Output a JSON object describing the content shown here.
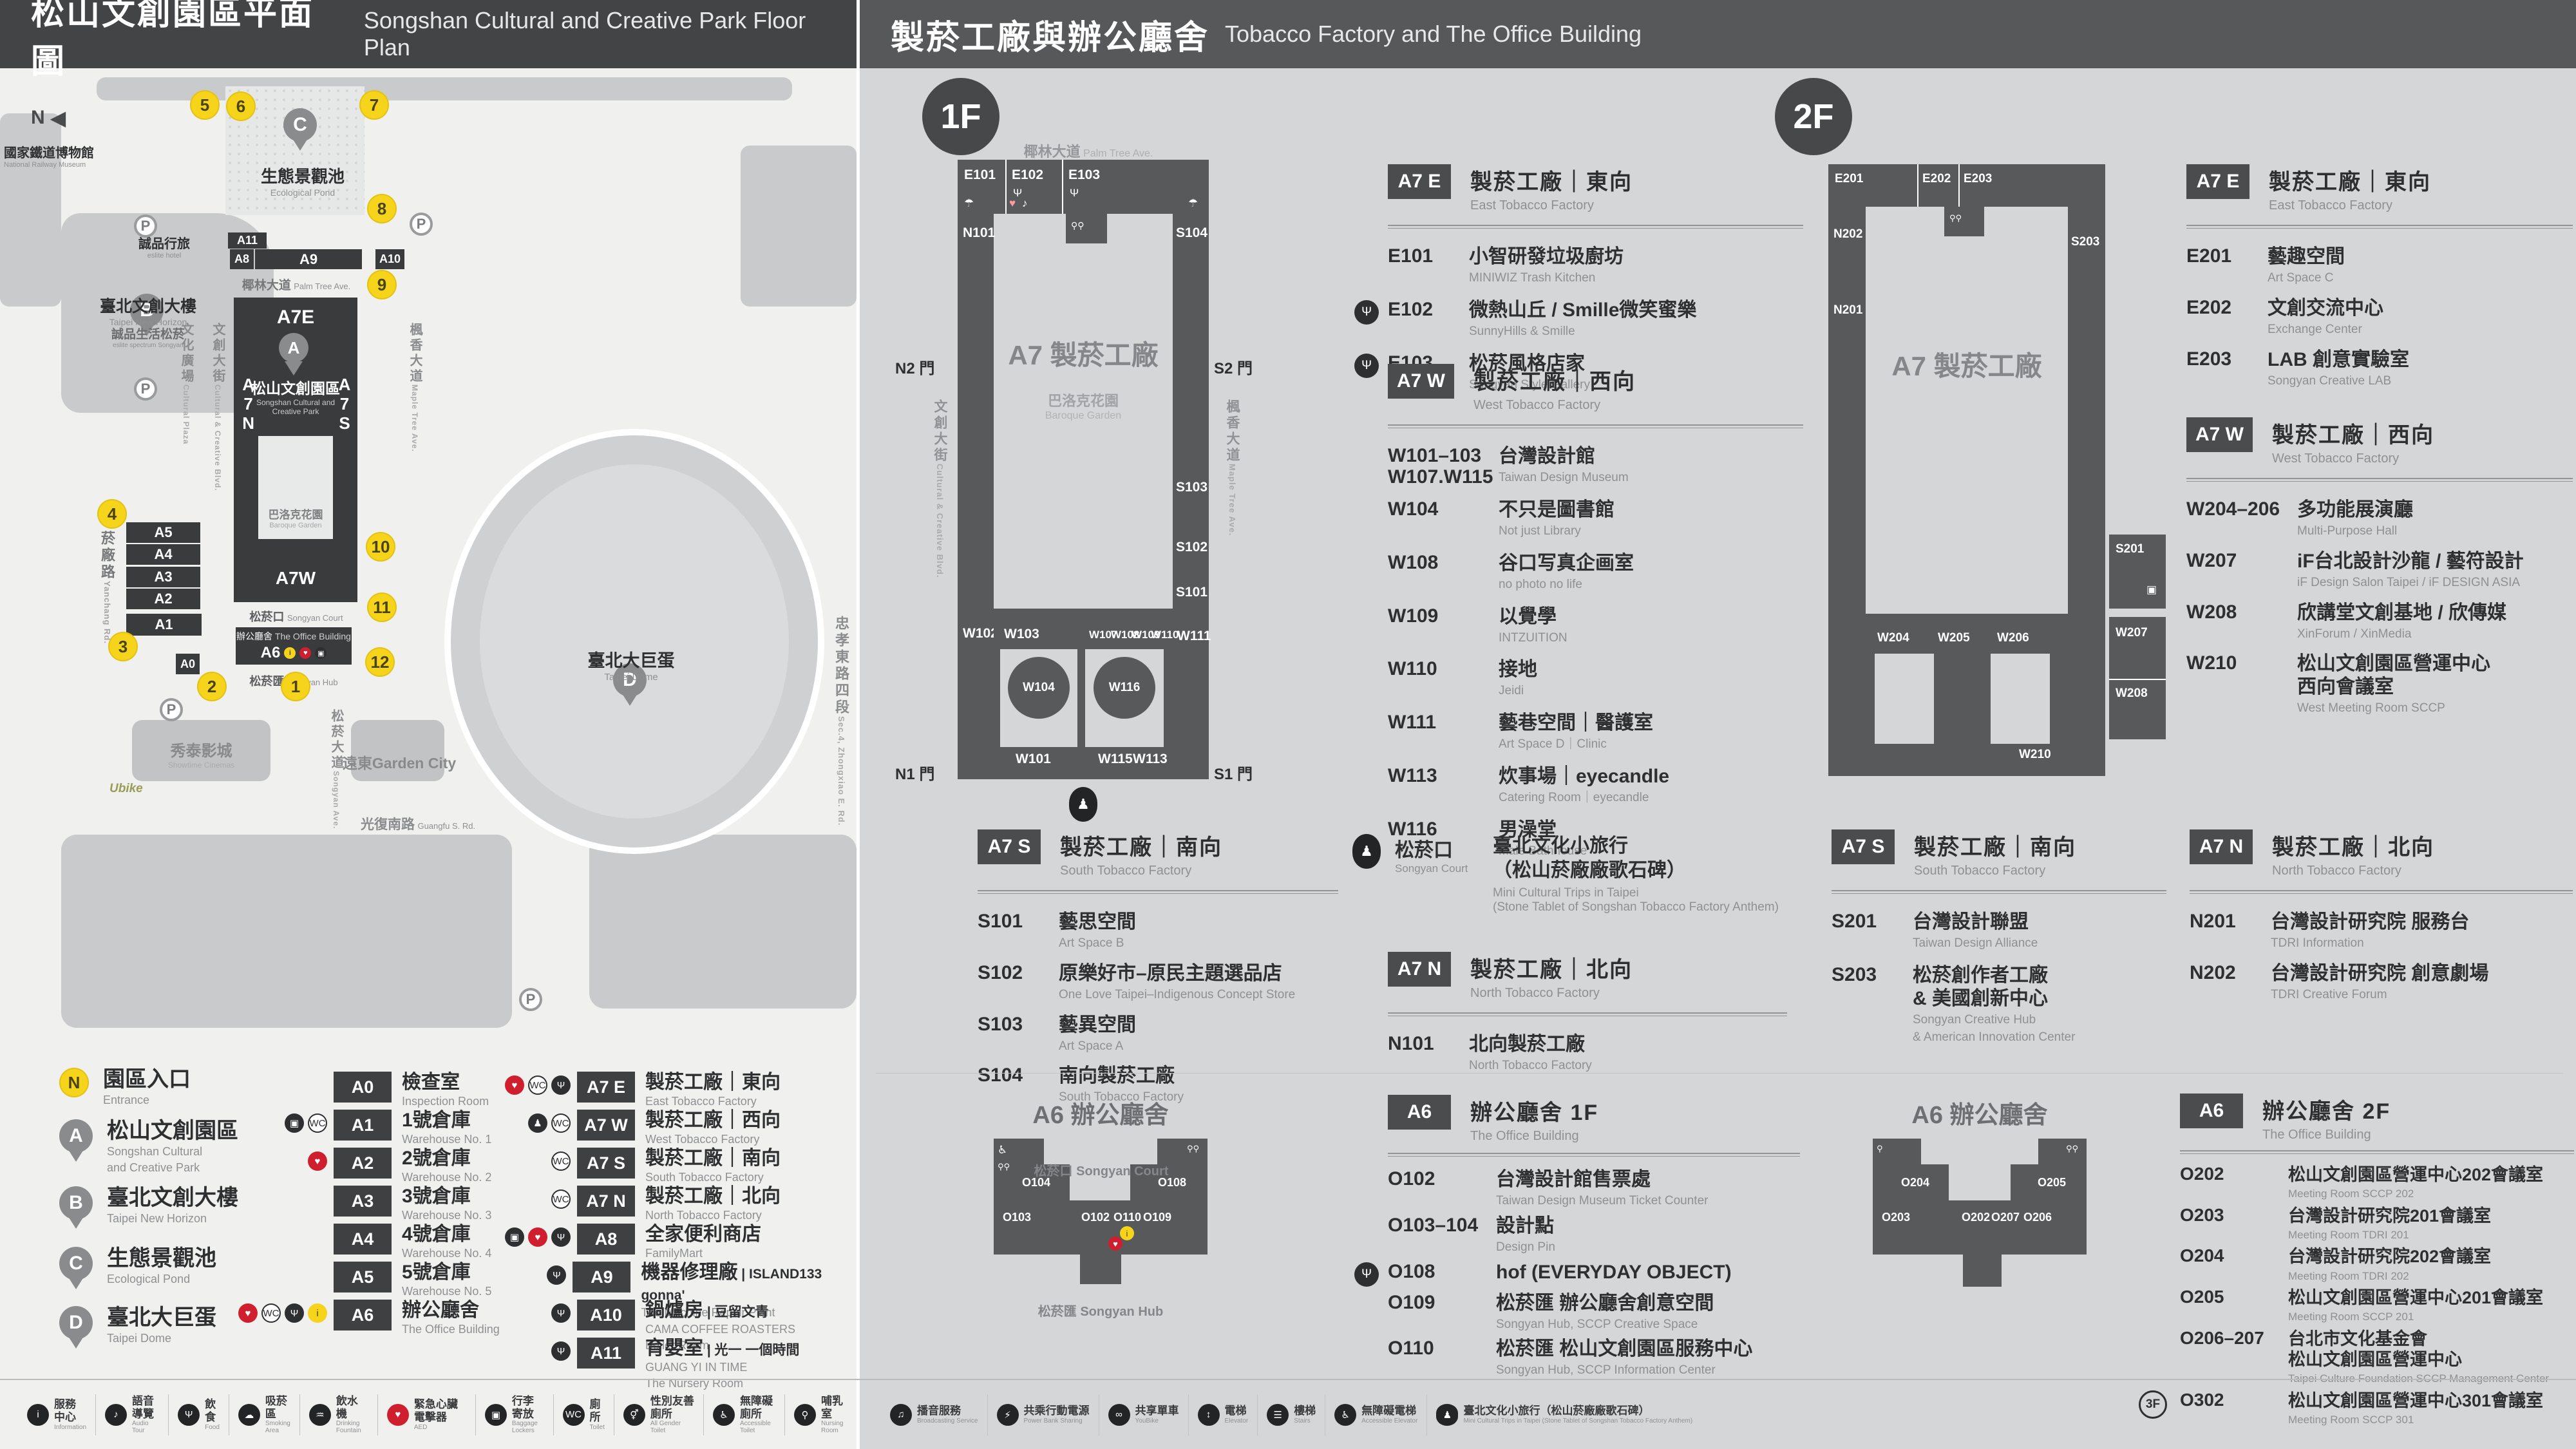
{
  "header": {
    "left": {
      "zh": "松山文創園區平面圖",
      "en": "Songshan Cultural and Creative Park Floor Plan"
    },
    "right": {
      "zh": "製菸工廠與辦公廳舍",
      "en": "Tobacco Factory and The Office Building"
    }
  },
  "park": {
    "compass": "N",
    "parking": "P",
    "ubike": "Ubike",
    "museum": {
      "zh": "國家鐵道博物館",
      "en": "National Railway Museum"
    },
    "pond": {
      "letter": "C",
      "zh": "生態景觀池",
      "en": "Ecological Pond"
    },
    "eslite_hotel": {
      "zh": "誠品行旅",
      "en": "eslite hotel"
    },
    "new_horizon": {
      "letter": "B",
      "zh": "臺北文創大樓",
      "en": "Taipei New Horizon"
    },
    "eslite_spectrum": {
      "zh": "誠品生活松菸",
      "en": "eslite spectrum Songyan"
    },
    "sccp": {
      "letter": "A",
      "zh": "松山文創園區",
      "en1": "Songshan Cultural and",
      "en2": "Creative Park"
    },
    "baroque": {
      "zh": "巴洛克花園",
      "en": "Baroque Garden"
    },
    "court": {
      "zh": "松菸口",
      "en": "Songyan Court"
    },
    "office": {
      "zh": "辦公廳舍",
      "en": "The Office Building"
    },
    "hub": {
      "zh": "松菸匯",
      "en": "Songyan Hub"
    },
    "dome": {
      "letter": "D",
      "zh": "臺北大巨蛋",
      "en": "Taipei Dome"
    },
    "cinema": {
      "zh": "秀泰影城",
      "en": "Showtime Cinemas"
    },
    "garden_city": {
      "zh": "遠東Garden City"
    },
    "roads": {
      "yanchang": {
        "zh": "菸廠路",
        "en": "Yanchang Rd."
      },
      "zhongxiao": {
        "zh": "忠孝東路四段",
        "en": "Sec.4, Zhongxiao E. Rd."
      },
      "guangfu": {
        "zh": "光復南路",
        "en": "Guangfu S. Rd."
      },
      "palm": {
        "zh": "椰林大道",
        "en": "Palm Tree Ave."
      },
      "ccblvd": {
        "zh": "文創大街",
        "en": "Cultural & Creative Blvd."
      },
      "maple": {
        "zh": "楓香大道",
        "en": "Maple Tree Ave."
      },
      "plaza": {
        "zh": "文化廣場",
        "en": "Cultural Plaza"
      },
      "songyan": {
        "zh": "松菸大道",
        "en": "Songyan Ave."
      }
    },
    "blocks": {
      "a11": "A11",
      "a8": "A8",
      "a9": "A9",
      "a10": "A10",
      "a7e": "A7E",
      "a7w": "A7W",
      "a7n": "A7N",
      "a7s": "A7S",
      "a5": "A5",
      "a4": "A4",
      "a3": "A3",
      "a2": "A2",
      "a1": "A1",
      "a0": "A0",
      "a6": "A6"
    },
    "markers": [
      "1",
      "2",
      "3",
      "4",
      "5",
      "6",
      "7",
      "8",
      "9",
      "10",
      "11",
      "12"
    ]
  },
  "legend": {
    "points": [
      {
        "badge": "N",
        "zh": "園區入口",
        "en": "Entrance"
      },
      {
        "badge": "A",
        "zh": "松山文創園區",
        "en": "Songshan Cultural",
        "en2": "and Creative Park"
      },
      {
        "badge": "B",
        "zh": "臺北文創大樓",
        "en": "Taipei New Horizon"
      },
      {
        "badge": "C",
        "zh": "生態景觀池",
        "en": "Ecological Pond"
      },
      {
        "badge": "D",
        "zh": "臺北大巨蛋",
        "en": "Taipei Dome"
      }
    ],
    "acol": [
      {
        "code": "A0",
        "zh": "檢查室",
        "en": "Inspection Room",
        "icons": []
      },
      {
        "code": "A1",
        "zh": "1號倉庫",
        "en": "Warehouse No. 1",
        "icons": [
          {
            "g": "▣",
            "c": "",
            "n": "locker-icon"
          },
          {
            "g": "WC",
            "c": "out",
            "n": "restroom-icon"
          }
        ]
      },
      {
        "code": "A2",
        "zh": "2號倉庫",
        "en": "Warehouse No. 2",
        "icons": [
          {
            "g": "♥",
            "c": "red",
            "n": "aed-icon"
          }
        ]
      },
      {
        "code": "A3",
        "zh": "3號倉庫",
        "en": "Warehouse No. 3",
        "icons": []
      },
      {
        "code": "A4",
        "zh": "4號倉庫",
        "en": "Warehouse No. 4",
        "icons": []
      },
      {
        "code": "A5",
        "zh": "5號倉庫",
        "en": "Warehouse No. 5",
        "icons": []
      },
      {
        "code": "A6",
        "zh": "辦公廳舍",
        "en": "The Office Building",
        "icons": [
          {
            "g": "♥",
            "c": "red",
            "n": "aed-icon"
          },
          {
            "g": "WC",
            "c": "out",
            "n": "restroom-icon"
          },
          {
            "g": "Ψ",
            "c": "",
            "n": "restaurant-icon"
          },
          {
            "g": "i",
            "c": "yel",
            "n": "information-icon"
          }
        ]
      }
    ],
    "a7col": [
      {
        "code": "A7 E",
        "zh": "製菸工廠｜東向",
        "en": "East Tobacco Factory",
        "icons": [
          {
            "g": "♥",
            "c": "red",
            "n": "aed-icon"
          },
          {
            "g": "WC",
            "c": "out",
            "n": "restroom-icon"
          },
          {
            "g": "Ψ",
            "c": "",
            "n": "restaurant-icon"
          }
        ]
      },
      {
        "code": "A7 W",
        "zh": "製菸工廠｜西向",
        "en": "West Tobacco Factory",
        "icons": [
          {
            "g": "♟",
            "c": "",
            "n": "stone-tablet-icon"
          },
          {
            "g": "WC",
            "c": "out",
            "n": "restroom-icon"
          }
        ]
      },
      {
        "code": "A7 S",
        "zh": "製菸工廠｜南向",
        "en": "South Tobacco Factory",
        "icons": [
          {
            "g": "WC",
            "c": "out",
            "n": "restroom-icon"
          }
        ]
      },
      {
        "code": "A7 N",
        "zh": "製菸工廠｜北向",
        "en": "North Tobacco Factory",
        "icons": [
          {
            "g": "WC",
            "c": "out",
            "n": "restroom-icon"
          }
        ]
      },
      {
        "code": "A8",
        "zh": "全家便利商店",
        "en": "FamilyMart",
        "icons": [
          {
            "g": "▣",
            "c": "",
            "n": "locker-icon"
          },
          {
            "g": "♥",
            "c": "red",
            "n": "aed-icon"
          },
          {
            "g": "Ψ",
            "c": "",
            "n": "restaurant-icon"
          }
        ]
      },
      {
        "code": "A9",
        "zh": "機器修理廠",
        "partner": "ISLAND133 gonna'",
        "en": "The Machine Repair Plant",
        "icons": [
          {
            "g": "Ψ",
            "c": "",
            "n": "restaurant-icon"
          }
        ]
      },
      {
        "code": "A10",
        "zh": "鍋爐房",
        "partner": "豆留文青",
        "pen": "CAMA COFFEE ROASTERS",
        "en": "Boiler Room",
        "icons": [
          {
            "g": "Ψ",
            "c": "",
            "n": "restaurant-icon"
          }
        ]
      },
      {
        "code": "A11",
        "zh": "育嬰室",
        "partner": "光一 一個時間",
        "pen": "GUANG YI IN TIME",
        "en": "The Nursery Room",
        "icons": [
          {
            "g": "Ψ",
            "c": "",
            "n": "restaurant-icon"
          }
        ]
      }
    ]
  },
  "f1": {
    "badge": "1F",
    "plan": {
      "ave": {
        "zh": "椰林大道",
        "en": "Palm Tree Ave."
      },
      "roadL": {
        "zh": "文創大街",
        "en": "Cultural & Creative Blvd."
      },
      "roadR": {
        "zh": "楓香大道",
        "en": "Maple Tree Ave."
      },
      "gates": {
        "n2": "N2 門",
        "s2": "S2 門",
        "n1": "N1 門",
        "s1": "S1 門"
      },
      "center": "A7 製菸工廠",
      "sub_zh": "巴洛克花園",
      "sub_en": "Baroque Garden",
      "rooms": {
        "e101": "E101",
        "e102": "E102",
        "e103": "E103",
        "n101": "N101",
        "s104": "S104",
        "s103": "S103",
        "s102": "S102",
        "s101": "S101",
        "w102": "W102",
        "w103": "W103",
        "w107": "W107",
        "w108": "W108",
        "w109": "W109",
        "w110": "W110",
        "w111": "W111",
        "w104": "W104",
        "w116": "W116",
        "w101": "W101",
        "w115": "W115",
        "w113": "W113"
      }
    },
    "a7e": {
      "code": "A7 E",
      "zh": "製菸工廠｜東向",
      "en": "East Tobacco Factory",
      "rows": [
        {
          "code": "E101",
          "zh": "小智研發垃圾廚坊",
          "en": "MINIWIZ Trash Kitchen"
        },
        {
          "code": "E102",
          "zh": "微熱山丘 / Smille微笑蜜樂",
          "en": "SunnyHills & Smille",
          "icon": "Ψ"
        },
        {
          "code": "E103",
          "zh": "松菸風格店家",
          "en": "Songyan Style Gallery",
          "icon": "Ψ"
        }
      ]
    },
    "a7w": {
      "code": "A7 W",
      "zh": "製菸工廠｜西向",
      "en": "West Tobacco Factory",
      "rows": [
        {
          "code": "W101–103",
          "code2": "W107.W115",
          "zh": "台灣設計館",
          "en": "Taiwan Design Museum"
        },
        {
          "code": "W104",
          "zh": "不只是圖書館",
          "en": "Not just Library"
        },
        {
          "code": "W108",
          "zh": "谷口写真企画室",
          "en": "no photo no life"
        },
        {
          "code": "W109",
          "zh": "以覺學",
          "en": "INTZUITION"
        },
        {
          "code": "W110",
          "zh": "接地",
          "en": "Jeidi"
        },
        {
          "code": "W111",
          "zh": "藝巷空間｜醫護室",
          "en": "Art Space D｜Clinic"
        },
        {
          "code": "W113",
          "zh": "炊事場｜eyecandle",
          "en": "Catering Room｜eyecandle"
        },
        {
          "code": "W116",
          "zh": "男澡堂",
          "en": "Male Bathhouse"
        }
      ]
    },
    "a7s": {
      "code": "A7 S",
      "zh": "製菸工廠｜南向",
      "en": "South Tobacco Factory",
      "rows": [
        {
          "code": "S101",
          "zh": "藝思空間",
          "en": "Art Space B"
        },
        {
          "code": "S102",
          "zh": "原樂好市–原民主題選品店",
          "en": "One Love Taipei–Indigenous Concept Store"
        },
        {
          "code": "S103",
          "zh": "藝異空間",
          "en": "Art Space A"
        },
        {
          "code": "S104",
          "zh": "南向製菸工廠",
          "en": "South Tobacco Factory"
        }
      ]
    },
    "court": {
      "zh": "松菸口",
      "en": "Songyan Court",
      "t1": "臺北文化小旅行",
      "t2": "（松山菸廠廠歌石碑）",
      "e1": "Mini Cultural Trips in Taipei",
      "e2": "(Stone Tablet of Songshan Tobacco Factory Anthem)"
    },
    "a7n": {
      "code": "A7 N",
      "zh": "製菸工廠｜北向",
      "en": "North Tobacco Factory",
      "rows": [
        {
          "code": "N101",
          "zh": "北向製菸工廠",
          "en": "North Tobacco Factory"
        }
      ]
    },
    "a6": {
      "title": "A6 辦公廳舍",
      "badge": "A6",
      "zh": "辦公廳舍 1F",
      "en": "The Office Building",
      "court": "松菸口 Songyan Court",
      "hub": "松菸匯 Songyan Hub",
      "rooms": {
        "o104": "O104",
        "o103": "O103",
        "o102": "O102",
        "o110": "O110",
        "o109": "O109",
        "o108": "O108"
      },
      "rows": [
        {
          "code": "O102",
          "zh": "台灣設計館售票處",
          "en": "Taiwan Design Museum Ticket Counter"
        },
        {
          "code": "O103–104",
          "zh": "設計點",
          "en": "Design Pin"
        },
        {
          "code": "O108",
          "zh": "hof (EVERYDAY OBJECT)",
          "icon": "Ψ"
        },
        {
          "code": "O109",
          "zh": "松菸匯 辦公廳舍創意空間",
          "en": "Songyan Hub, SCCP Creative Space"
        },
        {
          "code": "O110",
          "zh": "松菸匯 松山文創園區服務中心",
          "en": "Songyan Hub, SCCP Information Center"
        }
      ]
    }
  },
  "f2": {
    "badge": "2F",
    "plan": {
      "center": "A7 製菸工廠",
      "rooms": {
        "e201": "E201",
        "e202": "E202",
        "e203": "E203",
        "n202": "N202",
        "n201": "N201",
        "s203": "S203",
        "s201": "S201",
        "w204": "W204",
        "w205": "W205",
        "w206": "W206",
        "w207": "W207",
        "w208": "W208",
        "w210": "W210"
      }
    },
    "a7e": {
      "code": "A7 E",
      "zh": "製菸工廠｜東向",
      "en": "East Tobacco Factory",
      "rows": [
        {
          "code": "E201",
          "zh": "藝趣空間",
          "en": "Art Space C"
        },
        {
          "code": "E202",
          "zh": "文創交流中心",
          "en": "Exchange Center"
        },
        {
          "code": "E203",
          "zh": "LAB 創意實驗室",
          "en": "Songyan Creative LAB"
        }
      ]
    },
    "a7w": {
      "code": "A7 W",
      "zh": "製菸工廠｜西向",
      "en": "West Tobacco Factory",
      "rows": [
        {
          "code": "W204–206",
          "zh": "多功能展演廳",
          "en": "Multi-Purpose Hall"
        },
        {
          "code": "W207",
          "zh": "iF台北設計沙龍 / 藝符設計",
          "en": "iF Design Salon Taipei / iF DESIGN ASIA"
        },
        {
          "code": "W208",
          "zh": "欣講堂文創基地 / 欣傳媒",
          "en": "XinForum / XinMedia"
        },
        {
          "code": "W210",
          "zh": "松山文創園區營運中心",
          "zh2": "西向會議室",
          "en": "West Meeting Room SCCP"
        }
      ]
    },
    "a7s": {
      "code": "A7 S",
      "zh": "製菸工廠｜南向",
      "en": "South Tobacco Factory",
      "rows": [
        {
          "code": "S201",
          "zh": "台灣設計聯盟",
          "en": "Taiwan Design Alliance"
        },
        {
          "code": "S203",
          "zh": "松菸創作者工廠",
          "zh2": "& 美國創新中心",
          "en": "Songyan Creative Hub",
          "en2": "& American Innovation Center"
        }
      ]
    },
    "a7n": {
      "code": "A7 N",
      "zh": "製菸工廠｜北向",
      "en": "North Tobacco Factory",
      "rows": [
        {
          "code": "N201",
          "zh": "台灣設計研究院 服務台",
          "en": "TDRI Information"
        },
        {
          "code": "N202",
          "zh": "台灣設計研究院 創意劇場",
          "en": "TDRI Creative Forum"
        }
      ]
    },
    "a6": {
      "title": "A6 辦公廳舍",
      "badge": "A6",
      "zh": "辦公廳舍 2F",
      "en": "The Office Building",
      "rooms": {
        "o204": "O204",
        "o203": "O203",
        "o202": "O202",
        "o207": "O207",
        "o206": "O206",
        "o205": "O205"
      },
      "rows": [
        {
          "code": "O202",
          "zh": "松山文創園區營運中心202會議室",
          "en": "Meeting Room SCCP 202"
        },
        {
          "code": "O203",
          "zh": "台灣設計研究院201會議室",
          "en": "Meeting Room TDRI 201"
        },
        {
          "code": "O204",
          "zh": "台灣設計研究院202會議室",
          "en": "Meeting Room TDRI 202"
        },
        {
          "code": "O205",
          "zh": "松山文創園區營運中心201會議室",
          "en": "Meeting Room SCCP 201"
        },
        {
          "code": "O206–207",
          "zh": "台北市文化基金會",
          "zh2": "松山文創園區營運中心",
          "en": "Taipei Culture Foundation SCCP Management Center"
        },
        {
          "code": "O302",
          "pre": "3F",
          "zh": "松山文創園區營運中心301會議室",
          "en": "Meeting Room SCCP 301"
        }
      ]
    }
  },
  "footer": {
    "left": [
      {
        "g": "i",
        "c": "",
        "zh": "服務中心",
        "en": "Information",
        "n": "information-icon"
      },
      {
        "g": "♪",
        "c": "",
        "zh": "語音導覽",
        "en": "Audio Tour",
        "n": "audio-tour-icon"
      },
      {
        "g": "Ψ",
        "c": "",
        "zh": "飲食",
        "en": "Food",
        "n": "food-icon"
      },
      {
        "g": "☁",
        "c": "",
        "zh": "吸菸區",
        "en": "Smoking Area",
        "n": "smoking-area-icon"
      },
      {
        "g": "♒",
        "c": "",
        "zh": "飲水機",
        "en": "Drinking Fountain",
        "n": "drinking-fountain-icon"
      },
      {
        "g": "♥",
        "c": "red",
        "zh": "緊急心臟電擊器",
        "en": "AED",
        "n": "aed-icon"
      },
      {
        "g": "▣",
        "c": "",
        "zh": "行李寄放",
        "en": "Baggage Lockers",
        "n": "locker-icon"
      },
      {
        "g": "WC",
        "c": "",
        "zh": "廁所",
        "en": "Toilet",
        "n": "toilet-icon"
      },
      {
        "g": "⚥",
        "c": "",
        "zh": "性別友善廁所",
        "en": "All Gender Toilet",
        "n": "all-gender-toilet-icon"
      },
      {
        "g": "♿",
        "c": "",
        "zh": "無障礙廁所",
        "en": "Accessible Toilet",
        "n": "accessible-toilet-icon"
      },
      {
        "g": "⚲",
        "c": "",
        "zh": "哺乳室",
        "en": "Nursing Room",
        "n": "nursing-room-icon"
      }
    ],
    "right": [
      {
        "g": "♫",
        "c": "",
        "zh": "播音服務",
        "en": "Broadcasting Service",
        "n": "broadcast-icon"
      },
      {
        "g": "⚡",
        "c": "",
        "zh": "共乘行動電源",
        "en": "Power Bank Sharing",
        "n": "power-bank-icon"
      },
      {
        "g": "∞",
        "c": "",
        "zh": "共享單車",
        "en": "YouBike",
        "n": "bike-share-icon"
      },
      {
        "g": "↕",
        "c": "",
        "zh": "電梯",
        "en": "Elevator",
        "n": "elevator-icon"
      },
      {
        "g": "☰",
        "c": "",
        "zh": "樓梯",
        "en": "Stairs",
        "n": "stairs-icon"
      },
      {
        "g": "♿",
        "c": "",
        "zh": "無障礙電梯",
        "en": "Accessible Elevator",
        "n": "accessible-elevator-icon"
      },
      {
        "g": "♟",
        "c": "oval",
        "zh": "臺北文化小旅行（松山菸廠廠歌石碑）",
        "en": "Mini Cultural Trips in Taipei (Stone Tablet of Songshan Tobacco Factory Anthem)",
        "n": "stone-tablet-icon"
      }
    ]
  }
}
